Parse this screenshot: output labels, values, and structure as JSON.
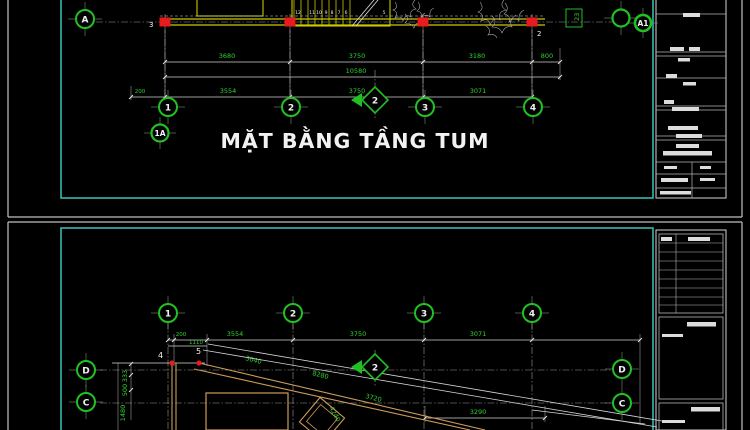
{
  "drawing": {
    "top": {
      "title": "MẶT BẰNG TẦNG TUM",
      "bubbles": {
        "a": "A",
        "a1": "A1",
        "c1": "1",
        "c2": "2",
        "c3": "3",
        "c4": "4",
        "extra": "1A"
      },
      "section_marker": "2",
      "dims_row1": [
        "3680",
        "3750",
        "3180",
        "800"
      ],
      "dim_total": "10580",
      "dims_row2": [
        "200",
        "3554",
        "3750",
        "3071"
      ],
      "stair_treads": [
        "12",
        "11",
        "10",
        "9",
        "8",
        "7",
        "6",
        "5"
      ],
      "column_labels": [
        "3",
        "2"
      ],
      "rotated_dim": "23"
    },
    "bottom": {
      "bubbles": {
        "c1": "1",
        "c2": "2",
        "c3": "3",
        "c4": "4",
        "d": "D",
        "c": "C"
      },
      "section_marker": "2",
      "dims_row": [
        "200",
        "1110",
        "3554",
        "3750",
        "3071"
      ],
      "vert_dims": [
        "333",
        "500",
        "1480"
      ],
      "diag_dims": [
        "3040",
        "8280",
        "3720",
        "4240"
      ],
      "dim_bottom": "3290",
      "point_labels": [
        "4",
        "5"
      ]
    },
    "colors": {
      "background": "#000000",
      "dimension_green": "#2fd32f",
      "bubble_green": "#22c022",
      "wall_yellow": "#c9c900",
      "wall_tan": "#cd9someone",
      "wall_tan_hex": "#cd9b5a",
      "column_red": "#e81c1c",
      "viewport_cyan": "#35b8ac",
      "frame_gray": "#c0c0c0",
      "text_white": "#f2f2f2"
    }
  }
}
